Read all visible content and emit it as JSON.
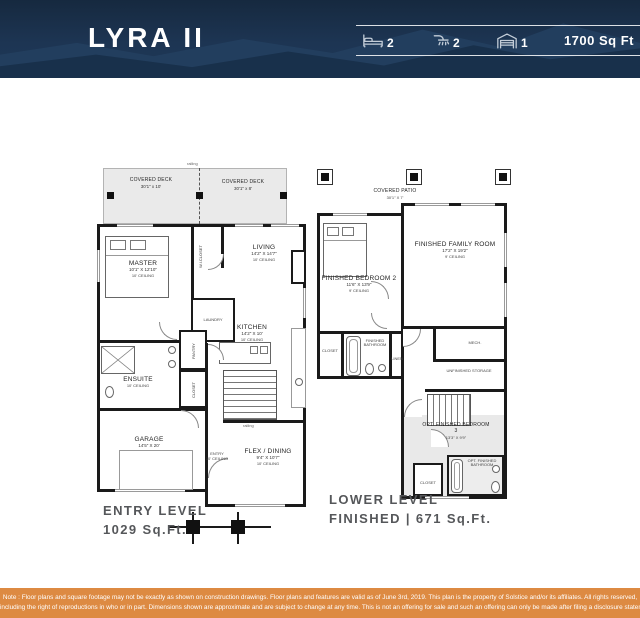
{
  "header": {
    "title": "LYRA II",
    "stats": {
      "beds": "2",
      "baths": "2",
      "garage": "1",
      "sqft": "1700 Sq Ft"
    }
  },
  "entry_level": {
    "label_title": "ENTRY LEVEL",
    "label_sqft": "1029 Sq.Ft.",
    "railing": "railing",
    "rooms": {
      "deck_left": {
        "name": "COVERED DECK",
        "dims": "30'1\" x 10'"
      },
      "deck_right": {
        "name": "COVERED DECK",
        "dims": "30'1\" x 8'"
      },
      "master": {
        "name": "MASTER",
        "dims": "10'1\" X 12'10\"",
        "ceiling": "10' CEILING"
      },
      "wic": {
        "name": "W.I.CLOSET"
      },
      "laundry": {
        "name": "LAUNDRY"
      },
      "living": {
        "name": "LIVING",
        "dims": "14'2\" X 14'7\"",
        "ceiling": "10' CEILING"
      },
      "ensuite": {
        "name": "ENSUITE",
        "ceiling": "10' CEILING"
      },
      "pantry": {
        "name": "PANTRY"
      },
      "closet": {
        "name": "CLOSET"
      },
      "kitchen": {
        "name": "KITCHEN",
        "dims": "14'2\" X 10'",
        "ceiling": "10' CEILING"
      },
      "garage": {
        "name": "GARAGE",
        "dims": "14'5\" X 20'"
      },
      "entry": {
        "name": "ENTRY",
        "ceiling": "10' CEILING"
      },
      "flex": {
        "name": "FLEX / DINING",
        "dims": "9'4\" X 10'7\"",
        "ceiling": "10' CEILING"
      }
    }
  },
  "lower_level": {
    "label_title": "LOWER LEVEL",
    "label_sqft": "FINISHED | 671 Sq.Ft.",
    "rooms": {
      "patio": {
        "name": "COVERED PATIO",
        "dims": "30'1\" X 7'"
      },
      "bedroom2": {
        "name": "FINISHED BEDROOM 2",
        "dims": "11'6\" X 13'9\"",
        "ceiling": "9' CEILING"
      },
      "family": {
        "name": "FINISHED FAMILY ROOM",
        "dims": "17'2\" X 19'2\"",
        "ceiling": "9' CEILING"
      },
      "closet1": {
        "name": "CLOSET"
      },
      "bathroom": {
        "name": "FINISHED BATHROOM"
      },
      "linen": {
        "name": "LINEN"
      },
      "mech": {
        "name": "MECH."
      },
      "storage": {
        "name": "UNFINISHED STORAGE"
      },
      "bedroom3": {
        "name": "OPT. FINISHED BEDROOM 3",
        "dims": "13'3\" X 9'9\""
      },
      "closet2": {
        "name": "CLOSET"
      },
      "optbath": {
        "name": "OPT. FINISHED BATHROOM"
      }
    }
  },
  "footer": {
    "line1": "Note : Floor plans and square footage may not be exactly as shown on construction drawings.  Floor plans and features are valid as of June 3rd, 2019.  This plan is the property of Solstice and/or its affiliates.  All rights reserved,",
    "line2": "including the right of reproductions in who or in part.  Dimensions shown are approximate and are subject to change at any time.  This is not an offering for sale and such an offering can only be made after filing a disclosure statement."
  },
  "colors": {
    "header_navy": "#1d3553",
    "footer_orange": "#dd8a42",
    "wall_black": "#1a1a1a",
    "label_gray": "#55575a"
  }
}
